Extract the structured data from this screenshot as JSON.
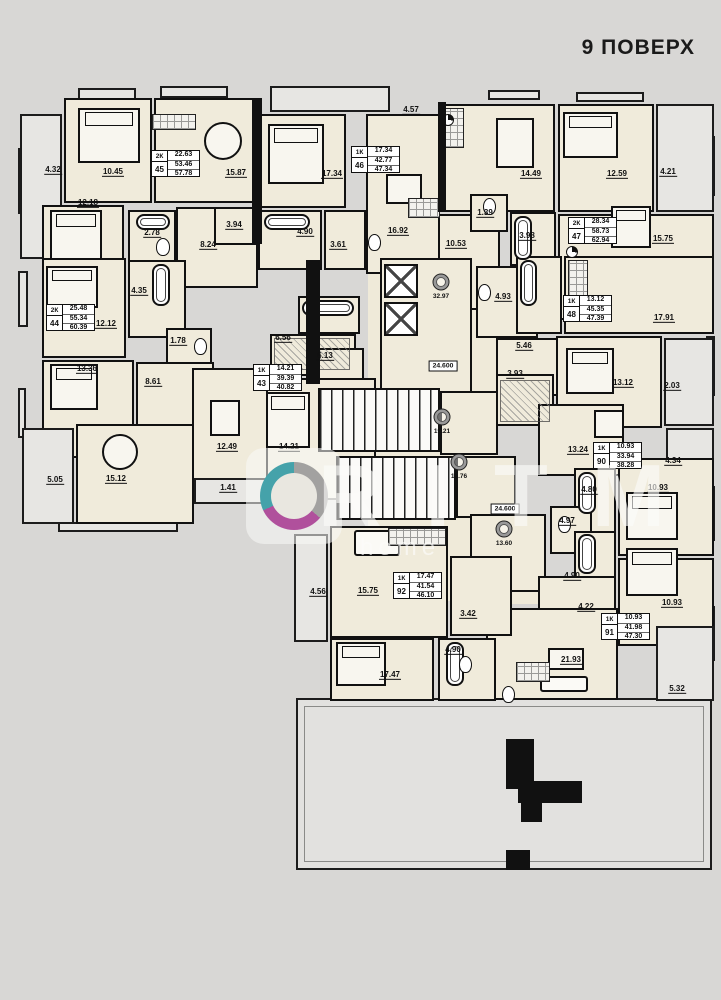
{
  "title": "9 ПОВЕРХ",
  "watermark": {
    "brand": "RITM",
    "sub": "home"
  },
  "colors": {
    "background": "#d8d7d5",
    "wall": "#111111",
    "room_fill": "#f0ebdb",
    "balcony_fill": "#e7e6e3",
    "logo_magenta": "#b0509c",
    "logo_teal": "#45a2aa"
  },
  "apartments": [
    {
      "id": "45",
      "type": "2К",
      "values": [
        "22.63",
        "53.46",
        "57.78"
      ],
      "x": 133,
      "y": 64
    },
    {
      "id": "46",
      "type": "1К",
      "values": [
        "17.34",
        "42.77",
        "47.34"
      ],
      "x": 333,
      "y": 60
    },
    {
      "id": "47",
      "type": "2К",
      "values": [
        "28.34",
        "58.73",
        "62.94"
      ],
      "x": 550,
      "y": 131
    },
    {
      "id": "44",
      "type": "2К",
      "values": [
        "25.48",
        "55.34",
        "60.39"
      ],
      "x": 28,
      "y": 218
    },
    {
      "id": "43",
      "type": "1К",
      "values": [
        "14.21",
        "39.39",
        "40.82"
      ],
      "x": 235,
      "y": 278
    },
    {
      "id": "48",
      "type": "1К",
      "values": [
        "13.12",
        "45.35",
        "47.39"
      ],
      "x": 545,
      "y": 209
    },
    {
      "id": "90",
      "type": "1К",
      "values": [
        "10.93",
        "33.94",
        "38.28"
      ],
      "x": 575,
      "y": 356
    },
    {
      "id": "92",
      "type": "1К",
      "values": [
        "17.47",
        "41.54",
        "46.10"
      ],
      "x": 375,
      "y": 486
    },
    {
      "id": "91",
      "type": "1К",
      "values": [
        "10.93",
        "41.98",
        "47.30"
      ],
      "x": 583,
      "y": 527
    }
  ],
  "dims": [
    {
      "v": "4.32",
      "x": 35,
      "y": 85
    },
    {
      "v": "10.45",
      "x": 95,
      "y": 87
    },
    {
      "v": "15.87",
      "x": 218,
      "y": 88
    },
    {
      "v": "12.18",
      "x": 70,
      "y": 118
    },
    {
      "v": "2.78",
      "x": 134,
      "y": 148
    },
    {
      "v": "3.94",
      "x": 216,
      "y": 140
    },
    {
      "v": "8.24",
      "x": 190,
      "y": 160
    },
    {
      "v": "4.57",
      "x": 393,
      "y": 25
    },
    {
      "v": "17.34",
      "x": 314,
      "y": 89
    },
    {
      "v": "16.92",
      "x": 380,
      "y": 146
    },
    {
      "v": "4.90",
      "x": 287,
      "y": 147
    },
    {
      "v": "3.61",
      "x": 320,
      "y": 160
    },
    {
      "v": "10.53",
      "x": 438,
      "y": 159
    },
    {
      "v": "14.49",
      "x": 513,
      "y": 89
    },
    {
      "v": "12.59",
      "x": 599,
      "y": 89
    },
    {
      "v": "4.21",
      "x": 650,
      "y": 87
    },
    {
      "v": "1.39",
      "x": 467,
      "y": 128
    },
    {
      "v": "3.98",
      "x": 509,
      "y": 151
    },
    {
      "v": "15.75",
      "x": 645,
      "y": 154
    },
    {
      "v": "4.35",
      "x": 121,
      "y": 206
    },
    {
      "v": "12.12",
      "x": 88,
      "y": 239
    },
    {
      "v": "13.36",
      "x": 69,
      "y": 284
    },
    {
      "v": "1.78",
      "x": 160,
      "y": 256
    },
    {
      "v": "8.61",
      "x": 135,
      "y": 297
    },
    {
      "v": "5.05",
      "x": 37,
      "y": 395
    },
    {
      "v": "15.12",
      "x": 98,
      "y": 394
    },
    {
      "v": "6.56",
      "x": 265,
      "y": 253
    },
    {
      "v": "6.13",
      "x": 307,
      "y": 271
    },
    {
      "v": "12.49",
      "x": 209,
      "y": 362
    },
    {
      "v": "14.21",
      "x": 271,
      "y": 362
    },
    {
      "v": "1.41",
      "x": 210,
      "y": 403
    },
    {
      "v": "4.93",
      "x": 485,
      "y": 212
    },
    {
      "v": "5.46",
      "x": 506,
      "y": 261
    },
    {
      "v": "3.93",
      "x": 497,
      "y": 289
    },
    {
      "v": "17.91",
      "x": 646,
      "y": 233
    },
    {
      "v": "13.12",
      "x": 605,
      "y": 298
    },
    {
      "v": "2.03",
      "x": 654,
      "y": 301
    },
    {
      "v": "13.24",
      "x": 560,
      "y": 365
    },
    {
      "v": "4.34",
      "x": 655,
      "y": 376
    },
    {
      "v": "4.80",
      "x": 571,
      "y": 405
    },
    {
      "v": "10.93",
      "x": 640,
      "y": 403
    },
    {
      "v": "4.97",
      "x": 549,
      "y": 436
    },
    {
      "v": "4.90",
      "x": 554,
      "y": 491
    },
    {
      "v": "10.93",
      "x": 654,
      "y": 518
    },
    {
      "v": "4.22",
      "x": 568,
      "y": 522
    },
    {
      "v": "21.93",
      "x": 553,
      "y": 575
    },
    {
      "v": "5.32",
      "x": 659,
      "y": 604
    },
    {
      "v": "4.56",
      "x": 300,
      "y": 507
    },
    {
      "v": "15.75",
      "x": 350,
      "y": 506
    },
    {
      "v": "3.42",
      "x": 450,
      "y": 529
    },
    {
      "v": "4.90",
      "x": 435,
      "y": 565
    },
    {
      "v": "17.47",
      "x": 372,
      "y": 590
    }
  ],
  "core_labels": [
    {
      "kind": "circle",
      "v": "32.97",
      "x": 423,
      "y": 196
    },
    {
      "kind": "circle",
      "v": "19.21",
      "x": 424,
      "y": 331
    },
    {
      "kind": "circle",
      "v": "18.76",
      "x": 441,
      "y": 376
    },
    {
      "kind": "circle",
      "v": "13.60",
      "x": 486,
      "y": 443
    },
    {
      "kind": "box",
      "v": "24.600",
      "x": 425,
      "y": 280
    },
    {
      "kind": "box",
      "v": "24.600",
      "x": 487,
      "y": 423
    }
  ],
  "furniture": [
    {
      "k": "bed",
      "x": 60,
      "y": 22,
      "w": 62,
      "h": 55
    },
    {
      "k": "bed",
      "x": 32,
      "y": 124,
      "w": 52,
      "h": 50
    },
    {
      "k": "bed",
      "x": 250,
      "y": 38,
      "w": 56,
      "h": 60
    },
    {
      "k": "bed",
      "x": 545,
      "y": 26,
      "w": 55,
      "h": 46
    },
    {
      "k": "bed",
      "x": 593,
      "y": 120,
      "w": 40,
      "h": 42
    },
    {
      "k": "bed",
      "x": 28,
      "y": 180,
      "w": 52,
      "h": 42
    },
    {
      "k": "bed",
      "x": 32,
      "y": 278,
      "w": 48,
      "h": 46
    },
    {
      "k": "bed",
      "x": 248,
      "y": 306,
      "w": 44,
      "h": 56
    },
    {
      "k": "bed",
      "x": 548,
      "y": 262,
      "w": 48,
      "h": 46
    },
    {
      "k": "bed",
      "x": 608,
      "y": 406,
      "w": 52,
      "h": 48
    },
    {
      "k": "bed",
      "x": 608,
      "y": 462,
      "w": 52,
      "h": 48
    },
    {
      "k": "bed",
      "x": 318,
      "y": 556,
      "w": 50,
      "h": 44
    },
    {
      "k": "table-round",
      "x": 186,
      "y": 36,
      "w": 38,
      "h": 38
    },
    {
      "k": "table-round",
      "x": 84,
      "y": 348,
      "w": 36,
      "h": 36
    },
    {
      "k": "table-rect",
      "x": 478,
      "y": 32,
      "w": 38,
      "h": 50
    },
    {
      "k": "table-rect",
      "x": 368,
      "y": 88,
      "w": 36,
      "h": 30
    },
    {
      "k": "table-rect",
      "x": 192,
      "y": 314,
      "w": 30,
      "h": 36
    },
    {
      "k": "table-rect",
      "x": 576,
      "y": 324,
      "w": 30,
      "h": 28
    },
    {
      "k": "table-rect",
      "x": 530,
      "y": 562,
      "w": 36,
      "h": 22
    },
    {
      "k": "sofa",
      "x": 336,
      "y": 444,
      "w": 46,
      "h": 26
    },
    {
      "k": "sofa",
      "x": 522,
      "y": 590,
      "w": 48,
      "h": 16
    },
    {
      "k": "tub",
      "x": 118,
      "y": 128,
      "w": 34,
      "h": 16
    },
    {
      "k": "tub",
      "x": 246,
      "y": 128,
      "w": 46,
      "h": 16
    },
    {
      "k": "tub",
      "x": 496,
      "y": 130,
      "w": 18,
      "h": 44
    },
    {
      "k": "tub",
      "x": 134,
      "y": 178,
      "w": 18,
      "h": 42
    },
    {
      "k": "tub",
      "x": 284,
      "y": 214,
      "w": 52,
      "h": 16
    },
    {
      "k": "tub",
      "x": 502,
      "y": 174,
      "w": 17,
      "h": 46
    },
    {
      "k": "tub",
      "x": 560,
      "y": 386,
      "w": 18,
      "h": 42
    },
    {
      "k": "tub",
      "x": 560,
      "y": 448,
      "w": 18,
      "h": 40
    },
    {
      "k": "tub",
      "x": 428,
      "y": 556,
      "w": 18,
      "h": 44
    },
    {
      "k": "wc",
      "x": 138,
      "y": 152,
      "w": 14,
      "h": 18
    },
    {
      "k": "wc",
      "x": 465,
      "y": 112,
      "w": 13,
      "h": 17
    },
    {
      "k": "wc",
      "x": 350,
      "y": 148,
      "w": 13,
      "h": 17
    },
    {
      "k": "wc",
      "x": 176,
      "y": 252,
      "w": 13,
      "h": 17
    },
    {
      "k": "wc",
      "x": 460,
      "y": 198,
      "w": 13,
      "h": 17
    },
    {
      "k": "wc",
      "x": 540,
      "y": 430,
      "w": 13,
      "h": 17
    },
    {
      "k": "wc",
      "x": 484,
      "y": 600,
      "w": 13,
      "h": 17
    },
    {
      "k": "wc",
      "x": 441,
      "y": 570,
      "w": 13,
      "h": 17
    },
    {
      "k": "counter",
      "x": 424,
      "y": 22,
      "w": 22,
      "h": 40
    },
    {
      "k": "counter",
      "x": 390,
      "y": 112,
      "w": 32,
      "h": 20
    },
    {
      "k": "counter",
      "x": 370,
      "y": 442,
      "w": 58,
      "h": 18
    },
    {
      "k": "counter",
      "x": 498,
      "y": 576,
      "w": 34,
      "h": 20
    },
    {
      "k": "counter",
      "x": 134,
      "y": 28,
      "w": 44,
      "h": 16
    },
    {
      "k": "counter",
      "x": 550,
      "y": 174,
      "w": 20,
      "h": 40
    },
    {
      "k": "stairs",
      "x": 300,
      "y": 302,
      "w": 122,
      "h": 64
    },
    {
      "k": "stairs",
      "x": 318,
      "y": 370,
      "w": 120,
      "h": 64
    },
    {
      "k": "lift",
      "x": 366,
      "y": 178,
      "w": 34,
      "h": 34
    },
    {
      "k": "lift",
      "x": 366,
      "y": 216,
      "w": 34,
      "h": 34
    },
    {
      "k": "vent",
      "x": 424,
      "y": 28,
      "w": 12,
      "h": 12
    },
    {
      "k": "vent",
      "x": 548,
      "y": 160,
      "w": 12,
      "h": 12
    },
    {
      "k": "hatch",
      "x": 482,
      "y": 294,
      "w": 50,
      "h": 42
    },
    {
      "k": "hatch",
      "x": 256,
      "y": 252,
      "w": 76,
      "h": 32
    },
    {
      "k": "wall",
      "x": 234,
      "y": 12,
      "w": 10,
      "h": 146
    },
    {
      "k": "wall",
      "x": 420,
      "y": 16,
      "w": 8,
      "h": 110
    },
    {
      "k": "wall",
      "x": 288,
      "y": 174,
      "w": 14,
      "h": 124
    },
    {
      "k": "wall",
      "x": 488,
      "y": 653,
      "w": 28,
      "h": 50
    },
    {
      "k": "wall",
      "x": 500,
      "y": 695,
      "w": 64,
      "h": 22
    },
    {
      "k": "wall",
      "x": 503,
      "y": 717,
      "w": 21,
      "h": 19
    },
    {
      "k": "wall",
      "x": 488,
      "y": 764,
      "w": 24,
      "h": 20
    }
  ]
}
